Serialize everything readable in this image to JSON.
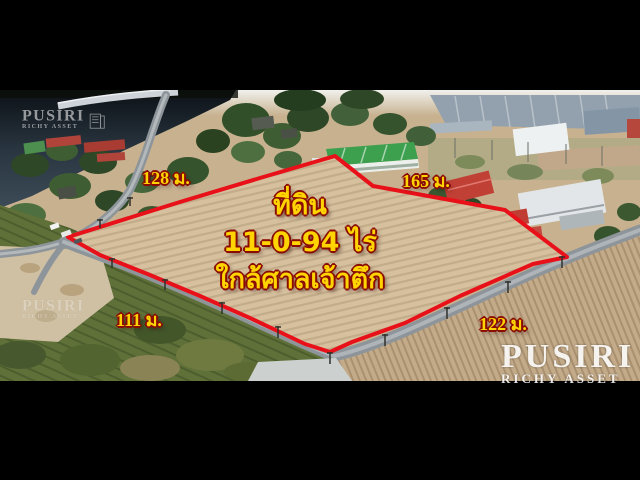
{
  "scene": {
    "description_note": "aerial drone photo of a land plot outlined in red, letterboxed on black",
    "plot_caption": {
      "line1": "ที่ดิน",
      "line2": "11-0-94 ไร่",
      "line3": "ใกล้ศาลเจ้าตึก"
    },
    "measurements": {
      "top_left": "128 ม.",
      "top_right": "165 ม.",
      "bottom_left": "111 ม.",
      "bottom_right": "122 ม."
    }
  },
  "watermarks": {
    "brand": "PUSIRI",
    "tagline": "RICHY ASSET"
  },
  "colors": {
    "boundary_red": "#e81119",
    "label_yellow": "#ffd400",
    "label_outline_red": "#8a0d04",
    "letterbox_black": "#000000",
    "field_tan": "#d6c09e",
    "water_dark": "#222b33"
  }
}
